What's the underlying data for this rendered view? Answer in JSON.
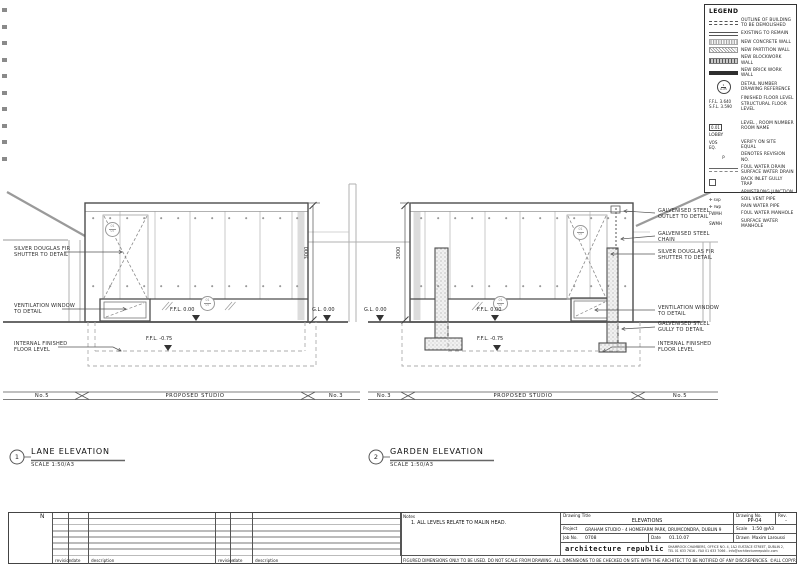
{
  "legend": {
    "title": "LEGEND",
    "items": [
      {
        "label": "OUTLINE OF BUILDING\nTO BE DEMOLISHED"
      },
      {
        "label": "EXISTING TO REMAIN"
      },
      {
        "label": "NEW CONCRETE WALL"
      },
      {
        "label": "NEW  PARTITION  WALL"
      },
      {
        "label": "NEW BLOCKWORK WALL"
      },
      {
        "label": "NEW BRICK WORK WALL"
      },
      {
        "sym_top": "1",
        "sym_bottom": "A-25",
        "label": "DETAIL NUMBER\nDRAWING REFERENCE"
      },
      {
        "sym": "F.F.L. 3.640\nS.F.L. 3.590",
        "label": "FINISHED FLOOR LEVEL\nSTRUCTURAL FLOOR LEVEL"
      },
      {
        "sym_box": "0.01",
        "sym_room": "LOBBY",
        "label": "LEVEL , ROOM NUMBER\nROOM NAME"
      },
      {
        "sym": "VOS\nEQ.",
        "label": "VERIFY ON SITE\nEQUAL"
      },
      {
        "sym": "P",
        "label": "DENOTES REVISION NO."
      },
      {
        "label": "FOUL WATER DRAIN\nSURFACE WATER DRAIN"
      },
      {
        "label": "BACK INLET GULLY TRAP"
      },
      {
        "label": "ARMSTRONG JUNCTION"
      },
      {
        "sym": "✛ svp",
        "label": "SOIL VENT PIPE"
      },
      {
        "sym": "✛ rwp",
        "label": "RAIN WATER PIPE"
      },
      {
        "sym": "FWMH",
        "label": "FOUL WATER MANHOLE"
      },
      {
        "sym": "SWMH",
        "label": "SURFACE WATER MANHOLE"
      }
    ]
  },
  "bubble": {
    "top": "01",
    "bottom": "07"
  },
  "lane": {
    "labels": {
      "shutter": "SILVER  DOUGLAS  FIR\nSHUTTER  TO  DETAIL",
      "vent": "VENTILATION  WINDOW\nTO  DETAIL",
      "iffl": "INTERNAL  FINISHED\nFLOOR  LEVEL"
    },
    "levels": {
      "ffl0": "F.F.L.  0.00",
      "fflm": "F.F.L.  -0.75",
      "gl": "G.L.  0.00"
    },
    "dim": "3000",
    "banner": {
      "left": "No.5",
      "mid": "PROPOSED  STUDIO",
      "right": "No.3"
    },
    "title": {
      "num": "1",
      "name": "LANE  ELEVATION",
      "scale": "SCALE  1:50/A3"
    }
  },
  "garden": {
    "labels": {
      "outlet": "GALVENISED  STEEL\nOUTLET  TO  DETAIL",
      "chain": "GALVENISED  STEEL\nCHAIN",
      "shutter": "SILVER  DOUGLAS  FIR\nSHUTTER  TO  DETAIL",
      "vent": "VENTILATION  WINDOW\nTO  DETAIL",
      "gully": "GALVENISED  STEEL\nGULLY  TO  DETAIL",
      "iffl": "INTERNAL  FINISHED\nFLOOR  LEVEL"
    },
    "levels": {
      "gl": "G.L.  0.00",
      "ffl0": "F.F.L.  0.00",
      "fflm": "F.F.L.  -0.75"
    },
    "dim": "3000",
    "banner": {
      "left": "No.3",
      "mid": "PROPOSED  STUDIO",
      "right": "No.5"
    },
    "title": {
      "num": "2",
      "name": "GARDEN  ELEVATION",
      "scale": "SCALE  1:50/A3"
    }
  },
  "north": {
    "label": "N"
  },
  "titleblock": {
    "rev_headers": {
      "revision": "revision",
      "date": "date",
      "description": "description"
    },
    "notes_label": "Notes",
    "note1": "1. ALL LEVELS RELATE TO MALIN HEAD.",
    "drawing_title_label": "Drawing Title",
    "drawing_title": "ELEVATIONS",
    "project_label": "Project",
    "project": "GRAHAM STUDIO - 4 HOMEFARM PARK, DRUMCONDRA, DUBLIN 9",
    "job_label": "Job No.",
    "job": "0708",
    "date_label": "Date",
    "date": "01.10.07",
    "firm": "architecture republic",
    "address": "SHAMROCK CHAMBERS, OFFICE NO. 4, 1&2 EUSTACE STREET, DUBLIN 2,\nTEL 01 633 7616 - FAX 01 633 7066 - info@architecturerepublic.com",
    "drawing_no_label": "Drawing No.",
    "drawing_no": "PP-04",
    "rev_label": "Rev.",
    "rev": "-",
    "scale_label": "Scale",
    "scale": "1:50 @A3",
    "drawn_label": "Drawn",
    "drawn": "Maxim Laroussi",
    "disclaimer": "FIGURED DIMENSIONS ONLY TO BE USED. DO NOT SCALE FROM DRAWING. ALL DIMENSIONS TO BE CHECKED ON SITE WITH THE ARCHITECT TO BE NOTIFIED OF ANY DISCREPENCIES. ©ALL COPYRIGHT RESERVED"
  }
}
